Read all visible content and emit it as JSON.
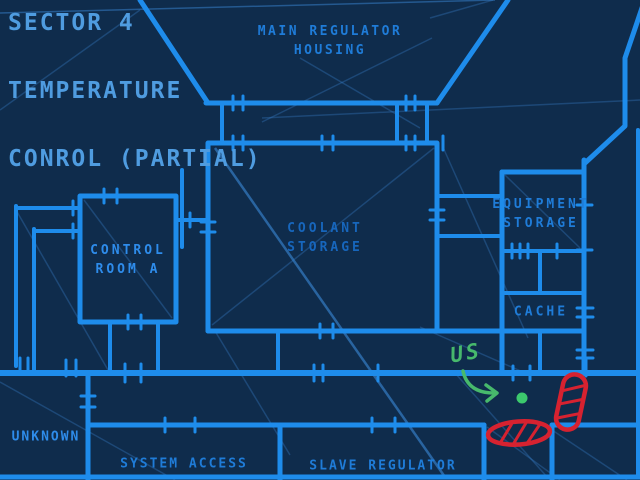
{
  "map": {
    "title_lines": [
      "SECTOR 4",
      "TEMPERATURE",
      "CONROL (PARTIAL)"
    ],
    "rooms": [
      {
        "id": "main-regulator-housing",
        "label": "MAIN REGULATOR\nHOUSING"
      },
      {
        "id": "control-room-a",
        "label": "CONTROL\nROOM A"
      },
      {
        "id": "coolant-storage",
        "label": "COOLANT\nSTORAGE"
      },
      {
        "id": "equipment-storage",
        "label": "EQUIPMENT\nSTORAGE"
      },
      {
        "id": "cache",
        "label": "CACHE"
      },
      {
        "id": "unknown",
        "label": "UNKNOWN"
      },
      {
        "id": "system-access",
        "label": "SYSTEM ACCESS"
      },
      {
        "id": "slave-regulator",
        "label": "SLAVE REGULATOR"
      }
    ],
    "annotations": {
      "us_label": "US"
    },
    "colors": {
      "background": "#0f2c4c",
      "wall": "#1e8ceb",
      "title_text": "#4f9ce0",
      "room_text_bright": "#2e8ceb",
      "room_text_mid": "#1f7cd8",
      "room_text_dim": "#1766bc",
      "annotation_green": "#47b96c",
      "dot_green": "#3cc96d",
      "annotation_red": "#d62230"
    }
  }
}
